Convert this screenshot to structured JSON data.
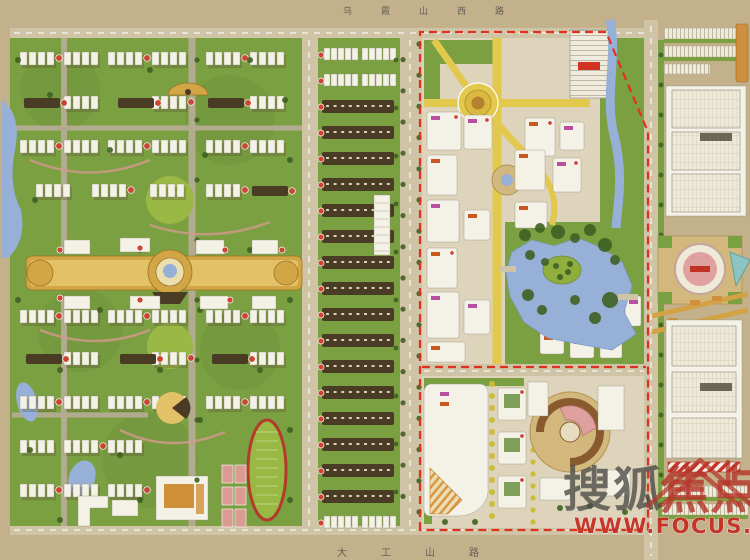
{
  "roads": {
    "top_label": "乌霞山西路",
    "bottom_label": "大工山路"
  },
  "watermark": {
    "brand_dark": "搜狐",
    "brand_red": "焦点",
    "url": "WWW.FOCUS.CN"
  },
  "colors": {
    "bg": "#c3b18c",
    "green": "#7ba042",
    "green_light": "#9ab844",
    "green_dark": "#3f6022",
    "road": "#cfc4a6",
    "building_white": "#f4f1e7",
    "building_dark": "#4a3b24",
    "gold": "#d2a545",
    "yellow_road": "#e3c84e",
    "water": "#96b0d8",
    "red_dash": "#e0301f",
    "marker_red": "#cc4433",
    "track_red": "#b23b2d",
    "court_pink": "#dc9a94",
    "plaza_pink": "#dfa0a0",
    "tan_frame": "#d2b87c",
    "watermark_dark": "#4b4a46",
    "watermark_red": "#b5362a",
    "url_red": "#c4281c",
    "label_dark": "#55504a"
  }
}
